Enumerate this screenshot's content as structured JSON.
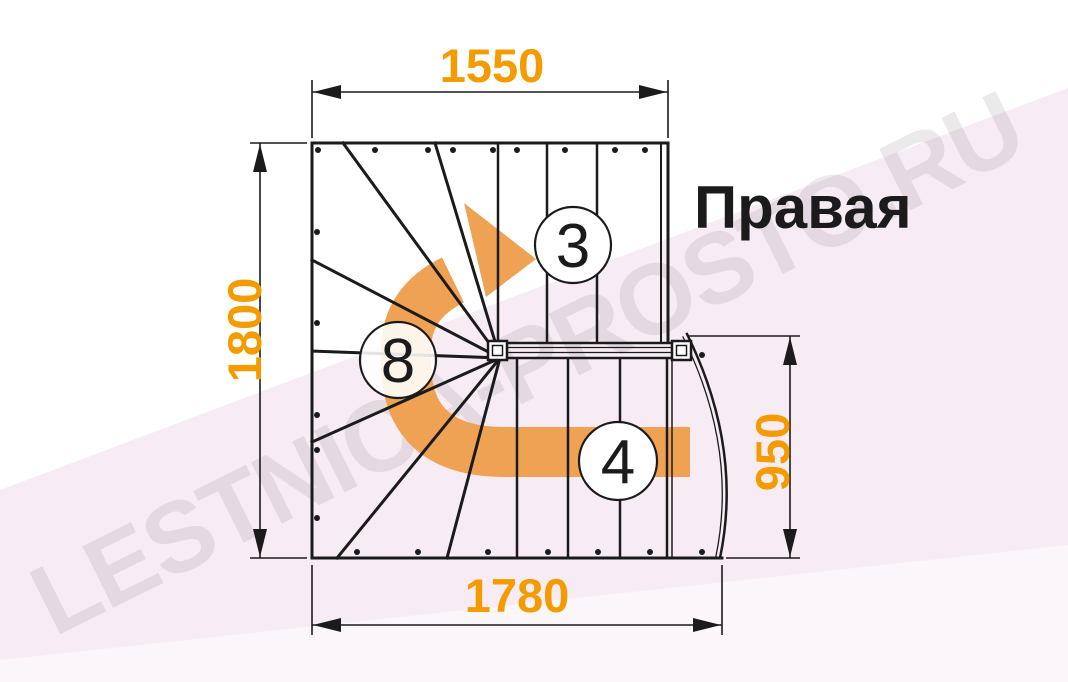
{
  "title": "Правая",
  "watermark": "LESTNICA-PROSTO.RU",
  "dimensions": {
    "top": "1550",
    "left": "1800",
    "right": "950",
    "bottom": "1780"
  },
  "step_counts": {
    "upper_flight": "3",
    "winders": "8",
    "lower_flight": "4"
  },
  "colors": {
    "dimension": "#F49B00",
    "arrow": "#EFA254",
    "line": "#1B1B1B",
    "background_tint": "#F7ECF3",
    "watermark": "#8C7B8A"
  }
}
